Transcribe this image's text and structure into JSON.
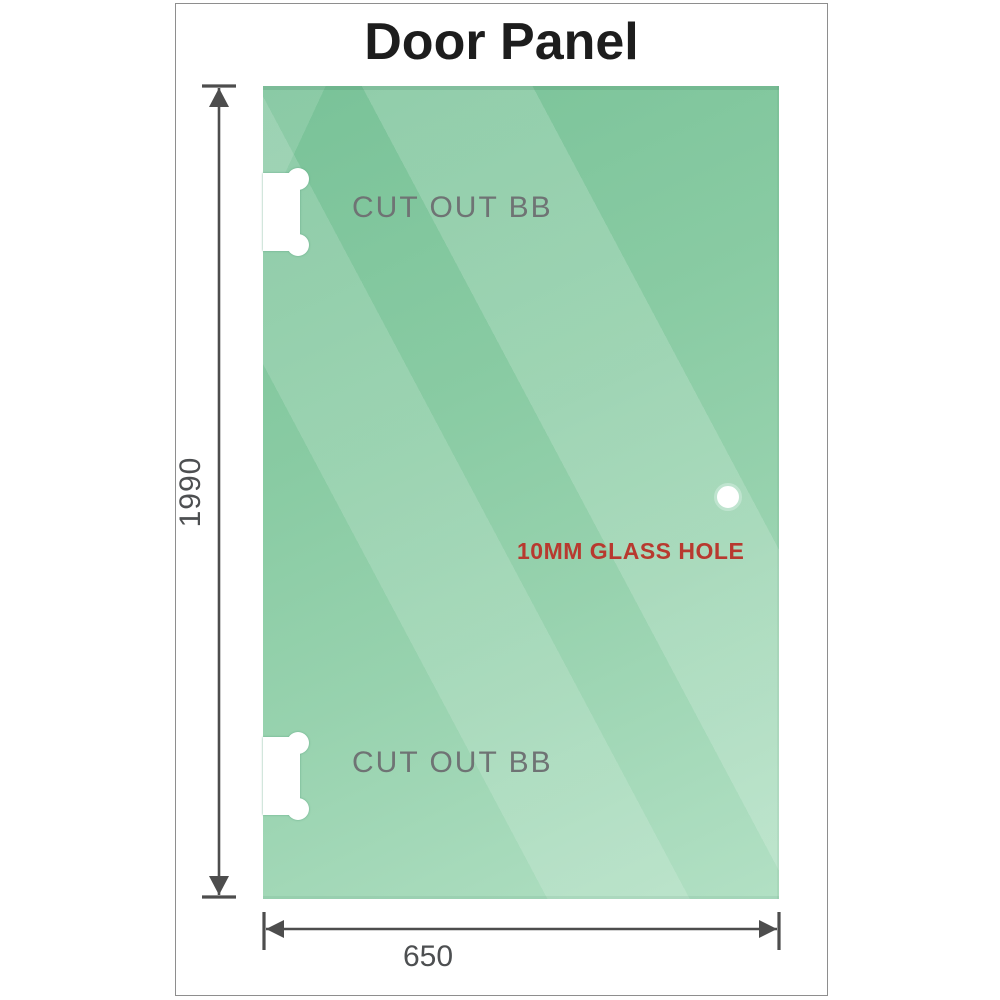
{
  "title": "Door Panel",
  "panel": {
    "cutout_top_label": "CUT OUT BB",
    "cutout_bottom_label": "CUT OUT BB",
    "hole_label": "10MM GLASS HOLE"
  },
  "dimensions": {
    "height": "1990",
    "width": "650"
  },
  "colors": {
    "glass_top": "#79c298",
    "glass_bottom": "#b2e0c4",
    "stripe_highlight": "rgba(255,255,255,0.16)",
    "cutout_label_gray": "#6f7374",
    "dimension_gray": "#4d4d4d",
    "hole_label_red": "#b8392f",
    "title_color": "#1d1d1d",
    "frame_border": "#8e8e8e"
  }
}
